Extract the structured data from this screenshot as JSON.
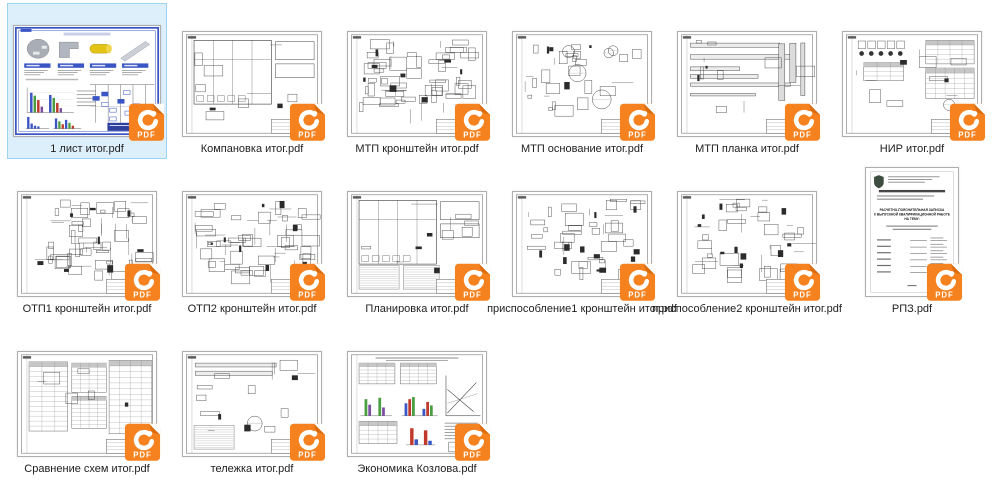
{
  "view": {
    "background": "#ffffff"
  },
  "selection": {
    "fill": "#ddeffb",
    "border": "#9ed4f0"
  },
  "badge": {
    "label": "PDF",
    "color": "#f5821f",
    "color_dark": "#d96c0e",
    "swirl": "#ffffff"
  },
  "palette": {
    "blue": "#3a55c4",
    "green": "#4a9e3f",
    "red": "#c0392b",
    "purple": "#7d4fa0",
    "yellow": "#e3c414",
    "ink": "#3a3a3a"
  },
  "titlepage": {
    "line1": "РАСЧЕТНО-ПОЯСНИТЕЛЬНАЯ ЗАПИСКА",
    "line2": "К ВЫПУСКНОЙ КВАЛИФИКАЦИОННОЙ РАБОТЕ",
    "line3": "НА ТЕМУ:"
  },
  "files": [
    {
      "name": "1 лист итог.pdf",
      "kind": "presentation",
      "selected": true,
      "orientation": "landscape"
    },
    {
      "name": "Компановка итог.pdf",
      "kind": "plan",
      "selected": false,
      "orientation": "landscape"
    },
    {
      "name": "МТП кронштейн итог.pdf",
      "kind": "dense",
      "selected": false,
      "orientation": "landscape"
    },
    {
      "name": "МТП основание итог.pdf",
      "kind": "parts",
      "selected": false,
      "orientation": "landscape"
    },
    {
      "name": "МТП планка итог.pdf",
      "kind": "bars",
      "selected": false,
      "orientation": "landscape"
    },
    {
      "name": "НИР итог.pdf",
      "kind": "research",
      "selected": false,
      "orientation": "landscape"
    },
    {
      "name": "ОТП1 кронштейн итог.pdf",
      "kind": "dense",
      "selected": false,
      "orientation": "landscape"
    },
    {
      "name": "ОТП2  кронштейн итог.pdf",
      "kind": "dense",
      "selected": false,
      "orientation": "landscape"
    },
    {
      "name": "Планировка итог.pdf",
      "kind": "plan2",
      "selected": false,
      "orientation": "landscape"
    },
    {
      "name": "приспособление1 кронштейн итог.pdf",
      "kind": "fixture",
      "selected": false,
      "orientation": "landscape"
    },
    {
      "name": "приспособление2 кронштейн итог.pdf",
      "kind": "fixture",
      "selected": false,
      "orientation": "landscape"
    },
    {
      "name": "РПЗ.pdf",
      "kind": "titlepage",
      "selected": false,
      "orientation": "portrait"
    },
    {
      "name": "Сравнение схем итог.pdf",
      "kind": "tables",
      "selected": false,
      "orientation": "landscape"
    },
    {
      "name": "тележка итог.pdf",
      "kind": "trolley",
      "selected": false,
      "orientation": "landscape"
    },
    {
      "name": "Экономика Козлова.pdf",
      "kind": "economics",
      "selected": false,
      "orientation": "landscape"
    }
  ]
}
